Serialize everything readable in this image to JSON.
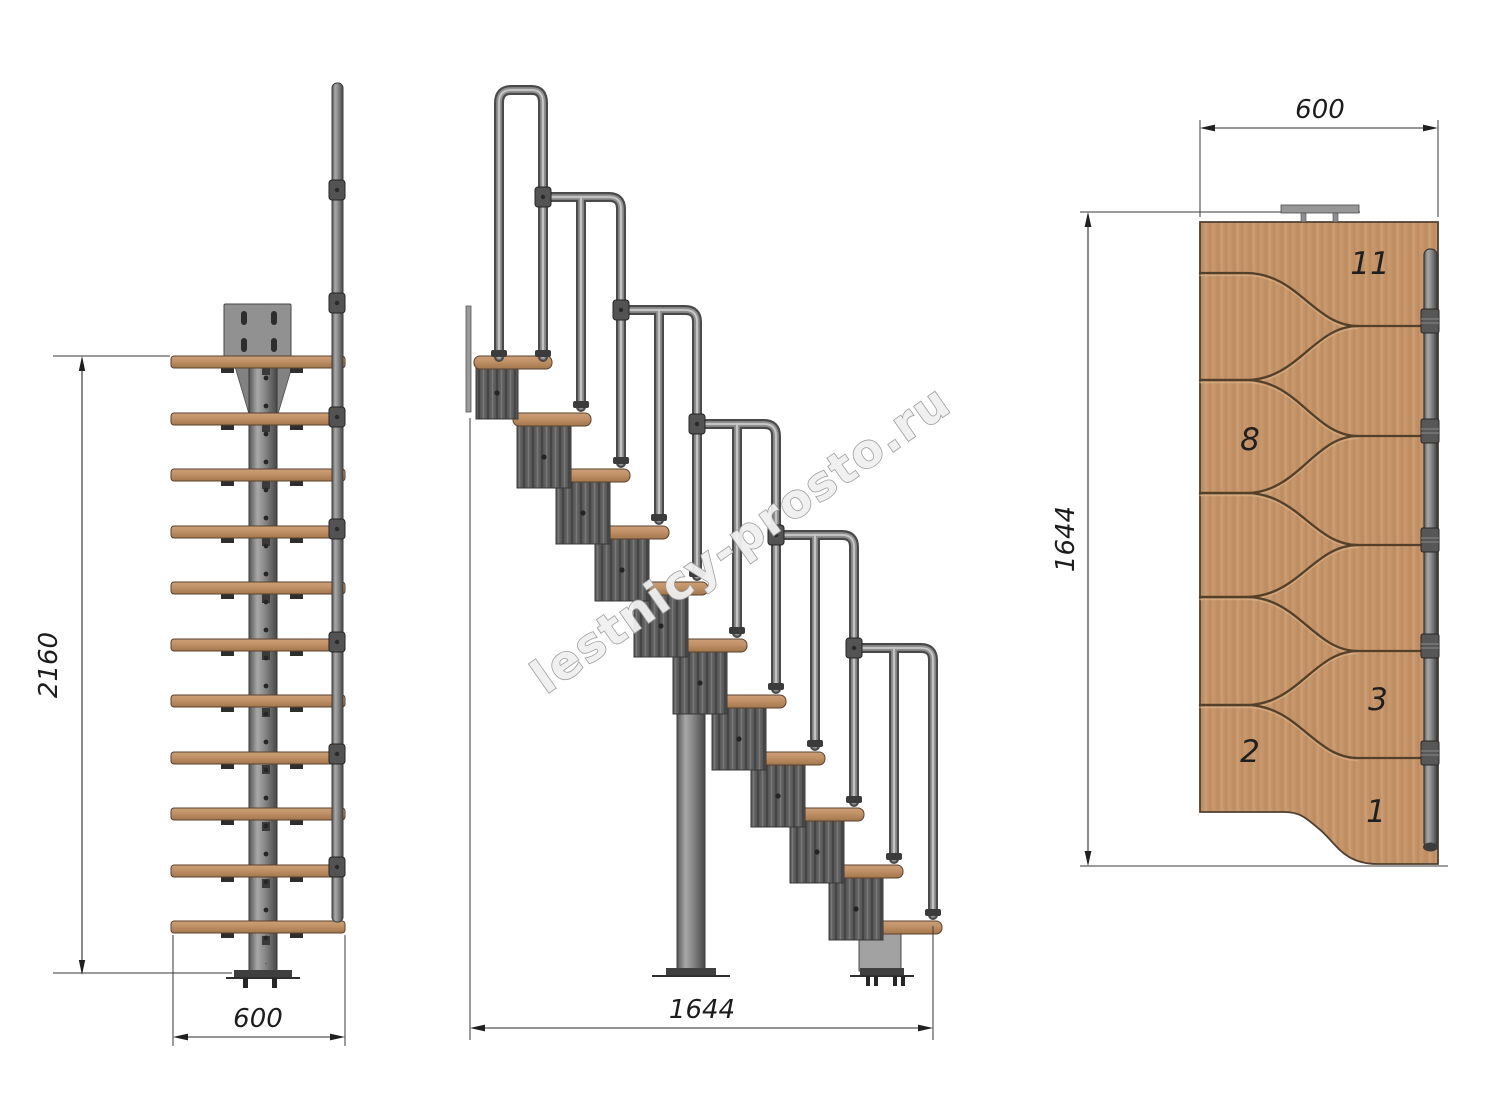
{
  "watermark": "lestnicy-prosto.ru",
  "front_view": {
    "height_dim": "2160",
    "width_dim": "600"
  },
  "side_view": {
    "length_dim": "1644"
  },
  "plan_view": {
    "width_dim": "600",
    "length_dim": "1644",
    "step_labels": [
      "11",
      "8",
      "3",
      "2",
      "1"
    ]
  },
  "colors": {
    "wood_light": "#cda077",
    "wood_dark": "#a3764c",
    "metal_light": "#a8a8a8",
    "metal_dark": "#474747",
    "seam_brown": "#53402b",
    "dimension_ink": "#1c1c1c",
    "watermark_gray": "#9d9d9d"
  }
}
